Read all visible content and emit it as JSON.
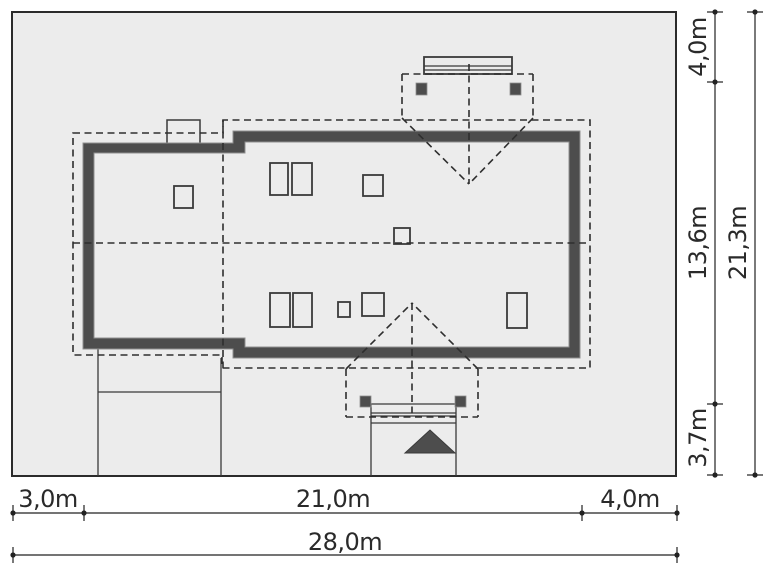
{
  "drawing": {
    "kind": "house-site-plan",
    "plot_width_label": "28,0m",
    "plot_height_label": "21,3m"
  },
  "colors": {
    "plot_fill": "#ececec",
    "wall_fill": "#4d4d4d",
    "line": "#2e2e2e",
    "background": "#ffffff"
  },
  "dim_bottom": {
    "left_setback": "3,0m",
    "house_width": "21,0m",
    "right_setback": "4,0m",
    "total_width": "28,0m"
  },
  "dim_right": {
    "top_setback": "4,0m",
    "house_depth": "13,6m",
    "bottom_setback": "3,7m",
    "total_depth": "21,3m"
  }
}
